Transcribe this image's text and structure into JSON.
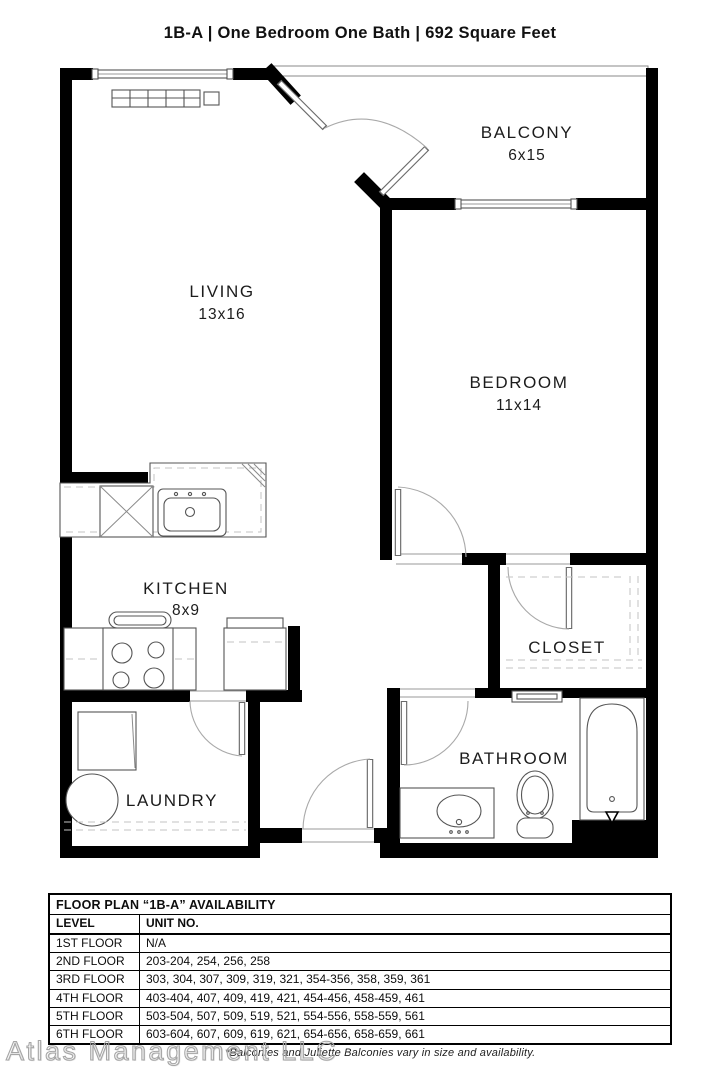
{
  "title": "1B-A | One Bedroom One Bath | 692 Square Feet",
  "floor_plan": {
    "rooms": [
      {
        "id": "balcony",
        "label": "BALCONY",
        "dims": "6x15"
      },
      {
        "id": "living",
        "label": "LIVING",
        "dims": "13x16"
      },
      {
        "id": "bedroom",
        "label": "BEDROOM",
        "dims": "11x14"
      },
      {
        "id": "kitchen",
        "label": "KITCHEN",
        "dims": "8x9"
      },
      {
        "id": "closet",
        "label": "CLOSET",
        "dims": ""
      },
      {
        "id": "bathroom",
        "label": "BATHROOM",
        "dims": ""
      },
      {
        "id": "laundry",
        "label": "LAUNDRY",
        "dims": ""
      }
    ]
  },
  "availability_table": {
    "title": "FLOOR PLAN “1B-A” AVAILABILITY",
    "columns": [
      "LEVEL",
      "UNIT NO."
    ],
    "rows": [
      [
        "1ST FLOOR",
        "N/A"
      ],
      [
        "2ND FLOOR",
        "203-204, 254, 256, 258"
      ],
      [
        "3RD FLOOR",
        "303, 304, 307, 309, 319, 321, 354-356, 358, 359, 361"
      ],
      [
        "4TH FLOOR",
        "403-404, 407, 409, 419, 421, 454-456, 458-459, 461"
      ],
      [
        "5TH FLOOR",
        "503-504, 507, 509, 519, 521, 554-556, 558-559, 561"
      ],
      [
        "6TH FLOOR",
        "603-604, 607, 609, 619, 621, 654-656, 658-659, 661"
      ]
    ]
  },
  "footer": {
    "watermark": "Atlas Management LLC",
    "note": "*Balconies and Juliette Balconies vary in size and availability."
  },
  "colors": {
    "wall": "#000000",
    "text": "#1c1c1c",
    "fixture_line": "#555555"
  }
}
